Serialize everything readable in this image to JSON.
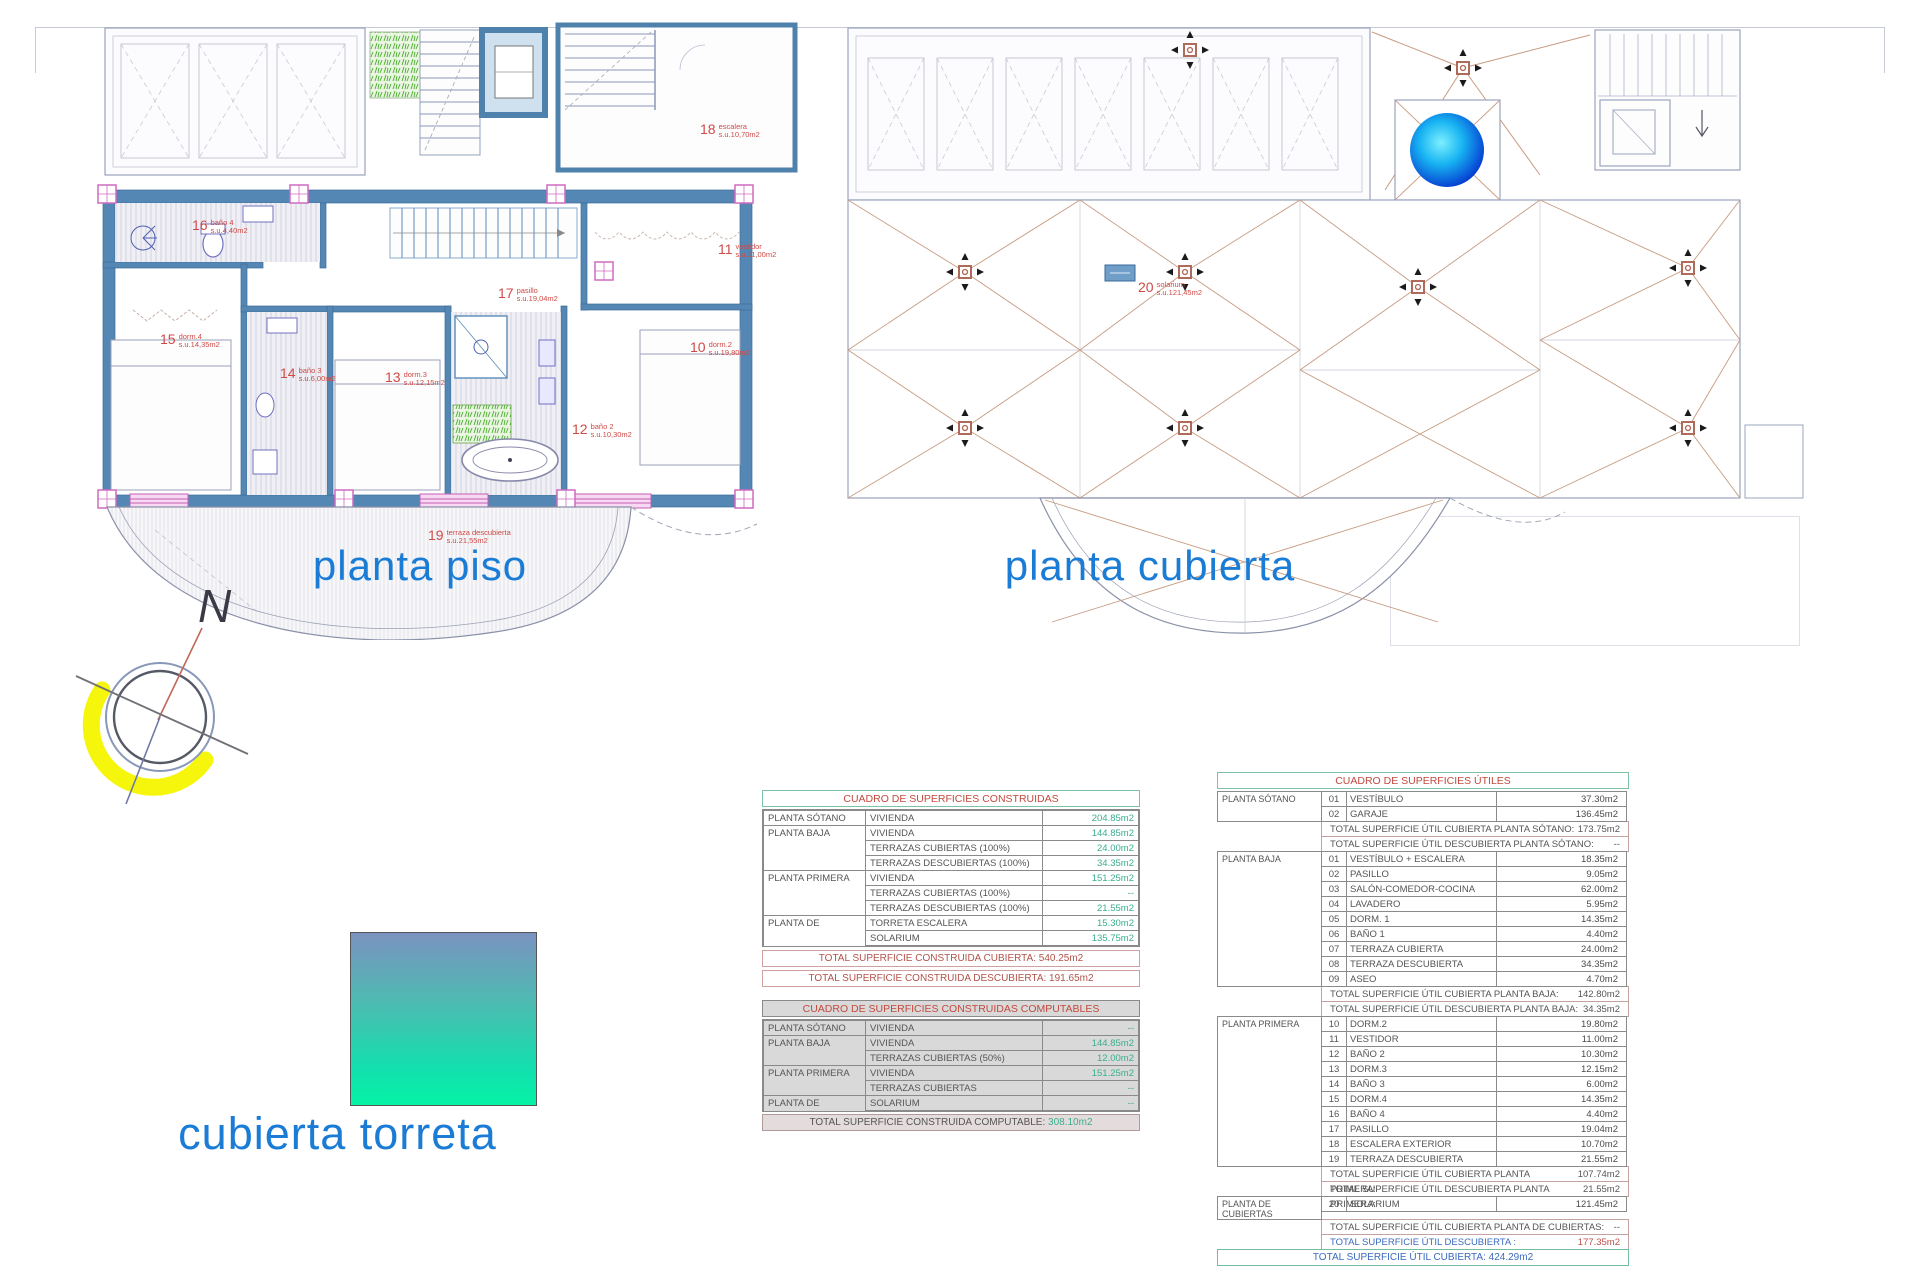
{
  "titles": {
    "left_plan": "planta piso",
    "right_plan": "planta cubierta",
    "torreta": "cubierta torreta",
    "north": "N"
  },
  "colors": {
    "accent_blue": "#1b7cd6",
    "label_red": "#cf4a45",
    "value_green": "#3aae8e",
    "wall_blue": "#5587b5",
    "roof_tan": "#c79b80",
    "highlight_yellow": "#f6f600"
  },
  "rooms": {
    "r10": {
      "num": "10",
      "name": "dorm.2",
      "area": "s.u.19,80m2"
    },
    "r11": {
      "num": "11",
      "name": "vestidor",
      "area": "s.u.11,00m2"
    },
    "r12": {
      "num": "12",
      "name": "baño 2",
      "area": "s.u.10,30m2"
    },
    "r13": {
      "num": "13",
      "name": "dorm.3",
      "area": "s.u.12,15m2"
    },
    "r14": {
      "num": "14",
      "name": "baño 3",
      "area": "s.u.6,00m2"
    },
    "r15": {
      "num": "15",
      "name": "dorm.4",
      "area": "s.u.14,35m2"
    },
    "r16": {
      "num": "16",
      "name": "baño 4",
      "area": "s.u.4,40m2"
    },
    "r17": {
      "num": "17",
      "name": "pasillo",
      "area": "s.u.19,04m2"
    },
    "r18": {
      "num": "18",
      "name": "escalera",
      "area": "s.u.10,70m2"
    },
    "r19": {
      "num": "19",
      "name": "terraza descubierta",
      "area": "s.u.21,55m2"
    },
    "r20": {
      "num": "20",
      "name": "solarium",
      "area": "s.u.121,45m2"
    }
  },
  "tables": {
    "construidas": {
      "title": "CUADRO DE SUPERFICIES CONSTRUIDAS",
      "rows": [
        {
          "plan": "PLANTA SÓTANO",
          "concept": "VIVIENDA",
          "value": "204.85m2",
          "pcls": ""
        },
        {
          "plan": "PLANTA BAJA",
          "concept": "VIVIENDA",
          "value": "144.85m2",
          "pcls": ""
        },
        {
          "plan": "",
          "concept": "TERRAZAS CUBIERTAS (100%)",
          "value": "24.00m2",
          "pcls": "cont"
        },
        {
          "plan": "",
          "concept": "TERRAZAS DESCUBIERTAS (100%)",
          "value": "34.35m2",
          "pcls": "cont"
        },
        {
          "plan": "PLANTA PRIMERA",
          "concept": "VIVIENDA",
          "value": "151.25m2",
          "pcls": ""
        },
        {
          "plan": "",
          "concept": "TERRAZAS CUBIERTAS (100%)",
          "value": "--",
          "pcls": "cont"
        },
        {
          "plan": "",
          "concept": "TERRAZAS DESCUBIERTAS (100%)",
          "value": "21.55m2",
          "pcls": "cont"
        },
        {
          "plan": "PLANTA DE CUBIERTAS",
          "concept": "TORRETA ESCALERA",
          "value": "15.30m2",
          "pcls": ""
        },
        {
          "plan": "",
          "concept": "SOLARIUM",
          "value": "135.75m2",
          "pcls": "cont"
        }
      ],
      "totals": [
        {
          "text": "TOTAL SUPERFICIE CONSTRUIDA CUBIERTA: 540.25m2"
        },
        {
          "text": "TOTAL SUPERFICIE CONSTRUIDA DESCUBIERTA: 191.65m2"
        }
      ]
    },
    "computables": {
      "title": "CUADRO DE SUPERFICIES CONSTRUIDAS COMPUTABLES",
      "rows": [
        {
          "plan": "PLANTA SÓTANO",
          "concept": "VIVIENDA",
          "value": "--",
          "pcls": ""
        },
        {
          "plan": "PLANTA BAJA",
          "concept": "VIVIENDA",
          "value": "144.85m2",
          "pcls": ""
        },
        {
          "plan": "",
          "concept": "TERRAZAS CUBIERTAS (50%)",
          "value": "12.00m2",
          "pcls": "cont"
        },
        {
          "plan": "PLANTA PRIMERA",
          "concept": "VIVIENDA",
          "value": "151.25m2",
          "pcls": ""
        },
        {
          "plan": "",
          "concept": "TERRAZAS CUBIERTAS",
          "value": "--",
          "pcls": "cont"
        },
        {
          "plan": "PLANTA DE CUBIERTAS",
          "concept": "SOLARIUM",
          "value": "--",
          "pcls": ""
        }
      ],
      "total_label": "TOTAL SUPERFICIE CONSTRUIDA COMPUTABLE:",
      "total_value": "308.10m2"
    },
    "utiles": {
      "title": "CUADRO DE SUPERFICIES ÚTILES",
      "sotano": {
        "label": "PLANTA SÓTANO",
        "rooms": [
          {
            "n": "01",
            "name": "VESTÍBULO",
            "v": "37.30m2"
          },
          {
            "n": "02",
            "name": "GARAJE",
            "v": "136.45m2"
          }
        ],
        "totals": [
          {
            "label": "TOTAL SUPERFICIE ÚTIL CUBIERTA PLANTA SÓTANO:",
            "value": "173.75m2",
            "lcls": "",
            "vcls": ""
          },
          {
            "label": "TOTAL SUPERFICIE ÚTIL DESCUBIERTA PLANTA SÓTANO:",
            "value": "--",
            "lcls": "",
            "vcls": ""
          }
        ]
      },
      "baja": {
        "label": "PLANTA BAJA",
        "rooms": [
          {
            "n": "01",
            "name": "VESTÍBULO + ESCALERA",
            "v": "18.35m2"
          },
          {
            "n": "02",
            "name": "PASILLO",
            "v": "9.05m2"
          },
          {
            "n": "03",
            "name": "SALÓN-COMEDOR-COCINA",
            "v": "62.00m2"
          },
          {
            "n": "04",
            "name": "LAVADERO",
            "v": "5.95m2"
          },
          {
            "n": "05",
            "name": "DORM. 1",
            "v": "14.35m2"
          },
          {
            "n": "06",
            "name": "BAÑO 1",
            "v": "4.40m2"
          },
          {
            "n": "07",
            "name": "TERRAZA CUBIERTA",
            "v": "24.00m2"
          },
          {
            "n": "08",
            "name": "TERRAZA DESCUBIERTA",
            "v": "34.35m2"
          },
          {
            "n": "09",
            "name": "ASEO",
            "v": "4.70m2"
          }
        ],
        "totals": [
          {
            "label": "TOTAL SUPERFICIE ÚTIL CUBIERTA PLANTA BAJA:",
            "value": "142.80m2",
            "lcls": "",
            "vcls": ""
          },
          {
            "label": "TOTAL SUPERFICIE ÚTIL DESCUBIERTA PLANTA BAJA:",
            "value": "34.35m2",
            "lcls": "",
            "vcls": ""
          }
        ]
      },
      "primera": {
        "label": "PLANTA PRIMERA",
        "rooms": [
          {
            "n": "10",
            "name": "DORM.2",
            "v": "19.80m2"
          },
          {
            "n": "11",
            "name": "VESTIDOR",
            "v": "11.00m2"
          },
          {
            "n": "12",
            "name": "BAÑO 2",
            "v": "10.30m2"
          },
          {
            "n": "13",
            "name": "DORM.3",
            "v": "12.15m2"
          },
          {
            "n": "14",
            "name": "BAÑO 3",
            "v": "6.00m2"
          },
          {
            "n": "15",
            "name": "DORM.4",
            "v": "14.35m2"
          },
          {
            "n": "16",
            "name": "BAÑO 4",
            "v": "4.40m2"
          },
          {
            "n": "17",
            "name": "PASILLO",
            "v": "19.04m2"
          },
          {
            "n": "18",
            "name": "ESCALERA EXTERIOR",
            "v": "10.70m2"
          },
          {
            "n": "19",
            "name": "TERRAZA DESCUBIERTA",
            "v": "21.55m2"
          }
        ],
        "totals": [
          {
            "label": "TOTAL SUPERFICIE ÚTIL CUBIERTA PLANTA PRIMERA:",
            "value": "107.74m2",
            "lcls": "",
            "vcls": ""
          },
          {
            "label": "TOTAL SUPERFICIE ÚTIL DESCUBIERTA PLANTA PRIMERA:",
            "value": "21.55m2",
            "lcls": "",
            "vcls": ""
          }
        ]
      },
      "cubiertas": {
        "label": "PLANTA DE CUBIERTAS",
        "rooms": [
          {
            "n": "20",
            "name": "SOLARIUM",
            "v": "121.45m2"
          }
        ],
        "totals": [
          {
            "label": "TOTAL SUPERFICIE ÚTIL CUBIERTA PLANTA DE CUBIERTAS:",
            "value": "--",
            "lcls": "",
            "vcls": ""
          },
          {
            "label": "TOTAL SUPERFICIE ÚTIL DESCUBIERTA :",
            "value": "177.35m2",
            "lcls": "blue",
            "vcls": "red"
          }
        ]
      },
      "grand": {
        "text": "TOTAL SUPERFICIE ÚTIL CUBIERTA: 424.29m2"
      }
    }
  }
}
